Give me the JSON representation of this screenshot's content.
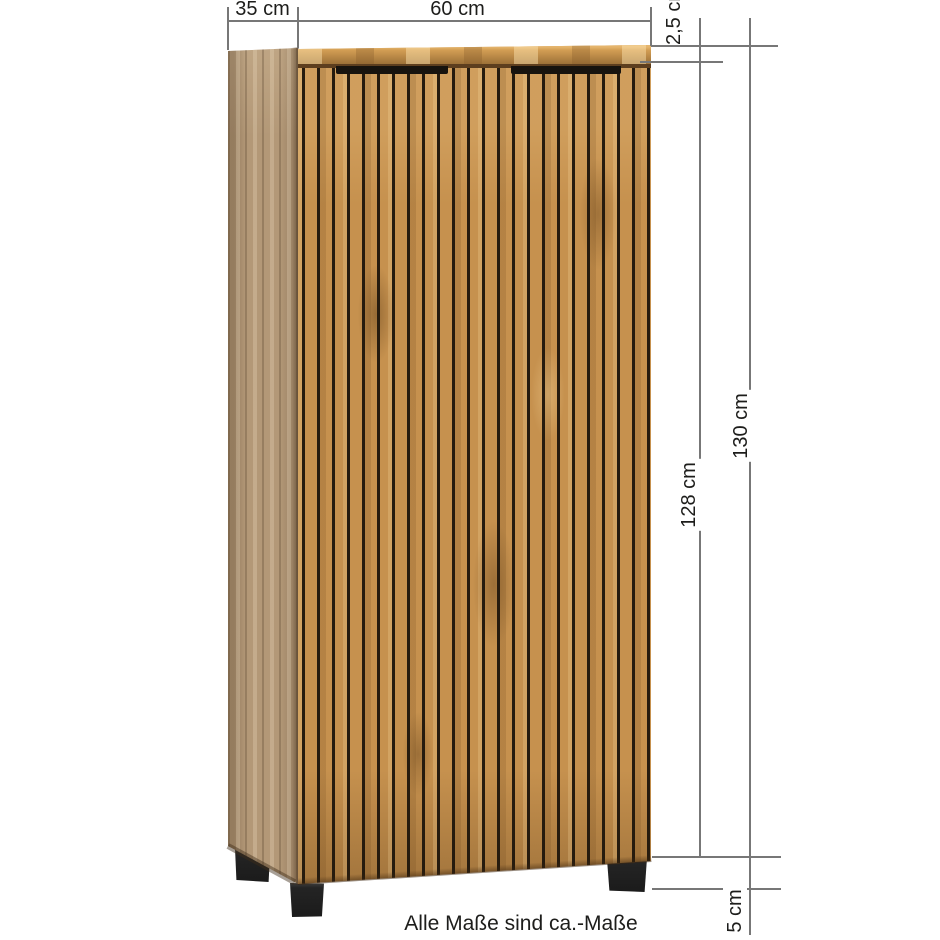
{
  "page": {
    "background": "#ffffff",
    "caption": "Alle Maße sind ca.-Maße"
  },
  "measurements": {
    "depth_label": "35 cm",
    "width_label": "60 cm",
    "top_thickness_label": "2,5 cm",
    "height_total_label": "130 cm",
    "height_body_label": "128 cm",
    "feet_height_label": "5 cm"
  },
  "cabinet": {
    "description": "oak-effect cabinet with vertical slatted front, two doors with black recessed handles and black feet"
  },
  "colors": {
    "wood-main": "#c6914e",
    "wood-top": "#d39e54",
    "wood-side": "#b39877",
    "groove": "#261b0e",
    "shadow-edge": "#5d3e1e",
    "handle": "#17130e",
    "foot": "#242424",
    "dim-line": "#777777",
    "text": "#1d1d1b"
  }
}
